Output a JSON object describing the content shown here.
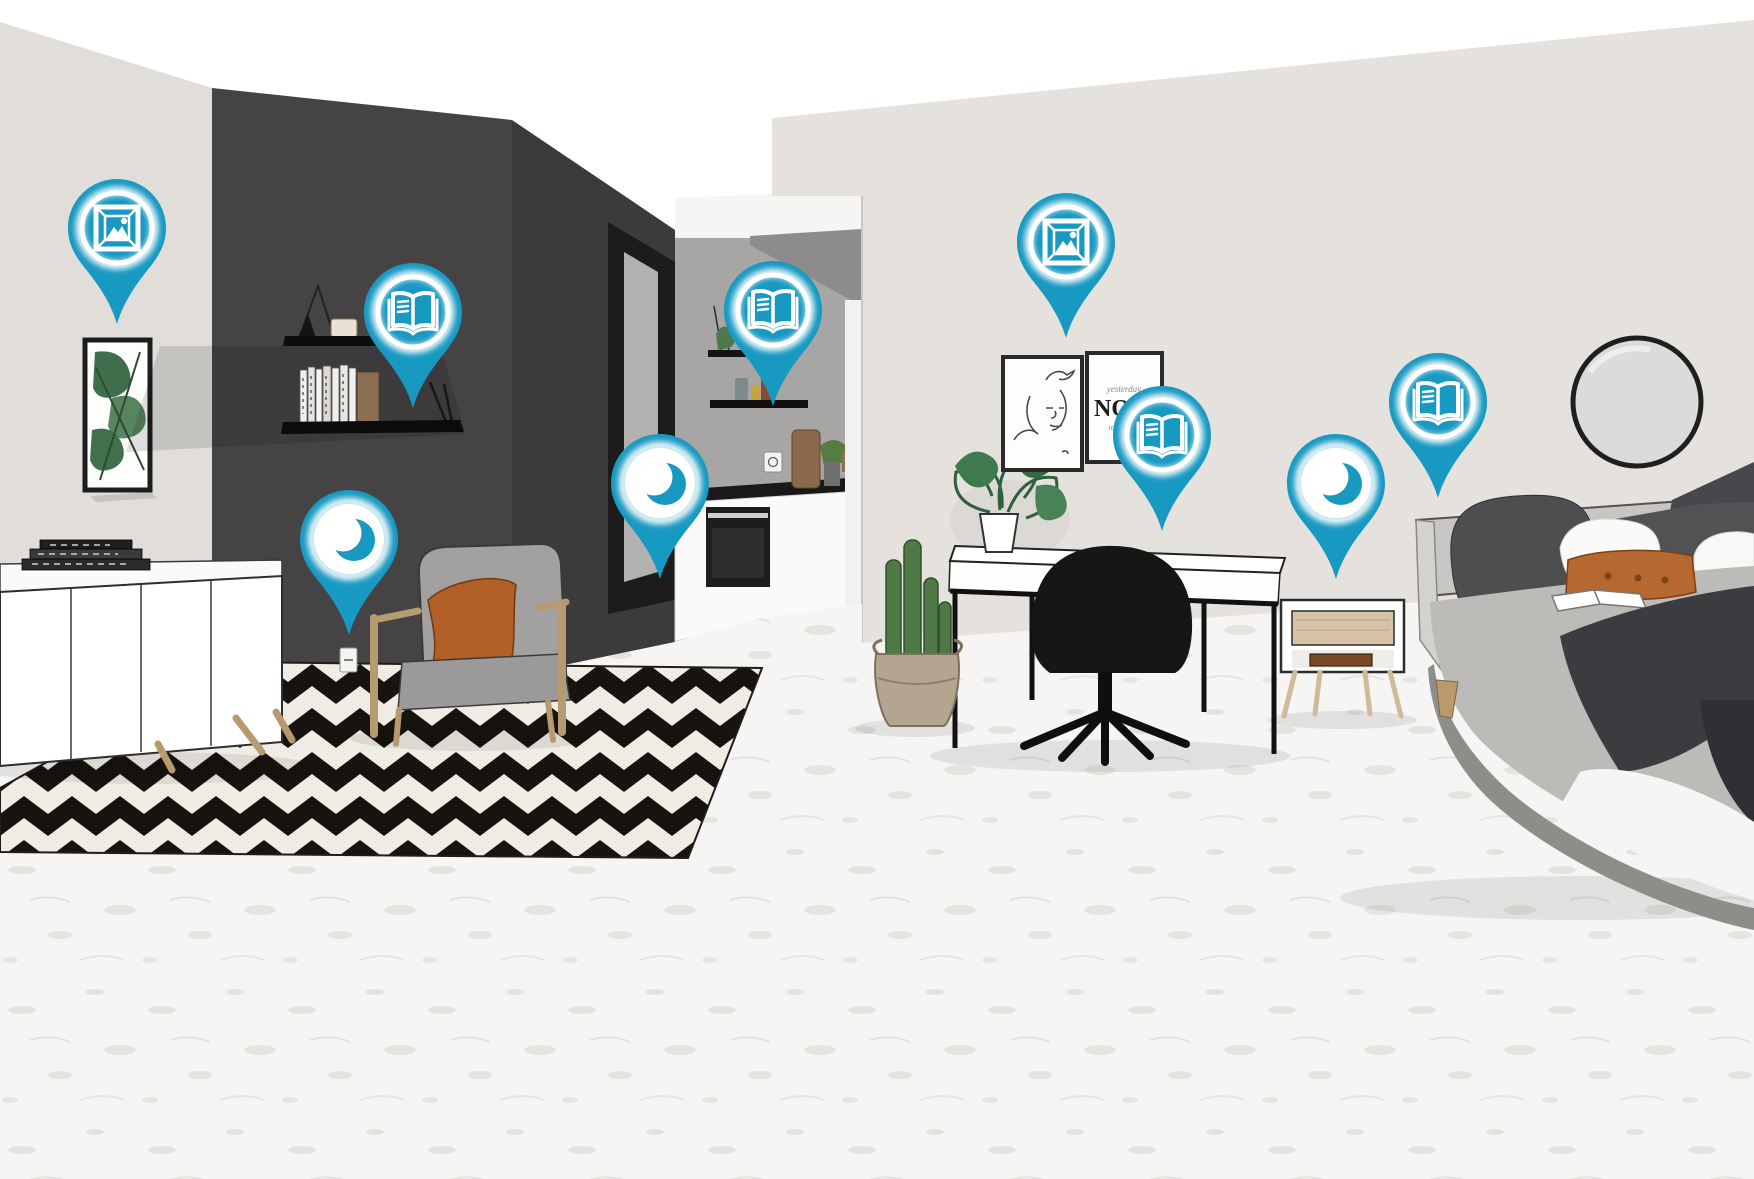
{
  "scene": {
    "poster": {
      "line1": "yesterday",
      "line2": "NOW",
      "line3": "tomorrow"
    }
  },
  "colors": {
    "pin": "#1899c2",
    "pin_glow": "#ffffff",
    "dark_wall": "#454343",
    "left_wall": "#e1deda",
    "right_wall": "#e5e2de",
    "kitchen_wall": "#a8a6a4",
    "floor": "#f6f5f3",
    "rug_black": "#17140f",
    "rug_cream": "#efece4",
    "accent_rust": "#b3602a"
  },
  "pins": [
    {
      "id": "artwork-living",
      "type": "picture",
      "icon": "picture-icon",
      "x": 117,
      "y": 326
    },
    {
      "id": "books-shelf",
      "type": "book",
      "icon": "book-icon",
      "x": 413,
      "y": 410
    },
    {
      "id": "sleep-armchair",
      "type": "moon",
      "icon": "moon-icon",
      "x": 349,
      "y": 637
    },
    {
      "id": "books-kitchen",
      "type": "book",
      "icon": "book-icon",
      "x": 773,
      "y": 408
    },
    {
      "id": "sleep-kitchen",
      "type": "moon",
      "icon": "moon-icon",
      "x": 660,
      "y": 581
    },
    {
      "id": "artwork-bedroom",
      "type": "picture",
      "icon": "picture-icon",
      "x": 1066,
      "y": 340
    },
    {
      "id": "books-desk",
      "type": "book",
      "icon": "book-icon",
      "x": 1162,
      "y": 533
    },
    {
      "id": "sleep-bedside",
      "type": "moon",
      "icon": "moon-icon",
      "x": 1336,
      "y": 581
    },
    {
      "id": "books-bed",
      "type": "book",
      "icon": "book-icon",
      "x": 1438,
      "y": 500
    }
  ]
}
